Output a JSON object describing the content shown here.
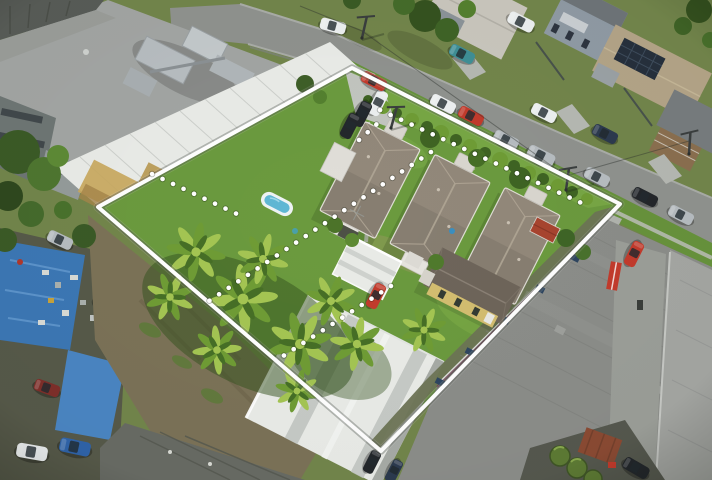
{
  "scene": {
    "kind": "aerial-drone-photograph",
    "subject": "residential land parcel outlined with white surveyed boundary and dotted internal lot lines",
    "setting": "suburban street with commercial warehouses surrounding the site",
    "visible_text": "none"
  },
  "overlay": {
    "solid_boundary_points": "352,68 620,204 381,451 98,207",
    "corners": {
      "north": [
        352,
        68
      ],
      "east": [
        620,
        204
      ],
      "south": [
        381,
        451
      ],
      "west": [
        98,
        207
      ]
    },
    "dotted_lines": [
      {
        "name": "front-setback-line",
        "d": "M380,110 L588,206"
      },
      {
        "name": "lot-divider-north",
        "d": "M431,152 L209,301"
      },
      {
        "name": "rear-lot-line",
        "d": "M152,174 L237,214"
      },
      {
        "name": "lot-divider-south",
        "d": "M391,286 L277,360"
      },
      {
        "name": "driveway-stub-line",
        "d": "M359,140 L378,123"
      }
    ]
  },
  "inventory": {
    "inside_boundary": [
      "three hip-roof cottages",
      "yellow cottage",
      "white carport",
      "white shed row",
      "kiddie pool",
      "palm tree cluster",
      "driveway with parked cars",
      "arched-roof garage building"
    ],
    "outside_boundary": [
      "street with parked cars",
      "neighbouring houses with solar panels",
      "large commercial building with rooftop AC plant",
      "white warehouse with tan patches",
      "junkyard with blue tarps and vehicles",
      "large grey warehouse",
      "green tanks and rust container"
    ]
  },
  "palette": {
    "grassBase": "#72854b",
    "grassLawn": "#6b9a3e",
    "grassBright": "#7cab48",
    "hedge": "#3f6423",
    "palmLight": "#a4c553",
    "palmMid": "#6f9c35",
    "palmDark": "#466f26",
    "road": "#8f928e",
    "concrete": "#c2c5bf",
    "roofTile": "#92887a",
    "roofRidge": "#b0a695",
    "gutter": "#e9e7e1",
    "yellowWall": "#d3bd70",
    "yellowRoof": "#6e655a",
    "whiteRoof": "#e9ebe7",
    "warehouseGray": "#8b8d89",
    "warehouseGray2": "#a4a6a2",
    "warehouseDark": "#686b64",
    "bldgRoof": "#a2a5a3",
    "bldgTan": "#b49a6a",
    "acUnit": "#b7bdc0",
    "tarpBlue": "#3c77b4",
    "tarpBlue2": "#4a85c2",
    "mud": "#7b7257",
    "rust": "#8a4a33",
    "tankGreen": "#5d7a34",
    "shedRed": "#a8442f",
    "carRed": "#c23b2c",
    "carMaroon": "#7e2f2a",
    "carWhite": "#eceff0",
    "carSilver": "#b6bcc0",
    "carDark": "#23272b",
    "carTeal": "#3f8f96",
    "carNavy": "#2c3a4e",
    "carBlue": "#2f63a8",
    "wallBlue": "#8f9aa4",
    "solar": "#26303c",
    "deckBrown": "#8a6f4f",
    "water": "#5fb7d4",
    "poolRim": "#eef3f4",
    "overlayWhite": "#ffffff"
  }
}
